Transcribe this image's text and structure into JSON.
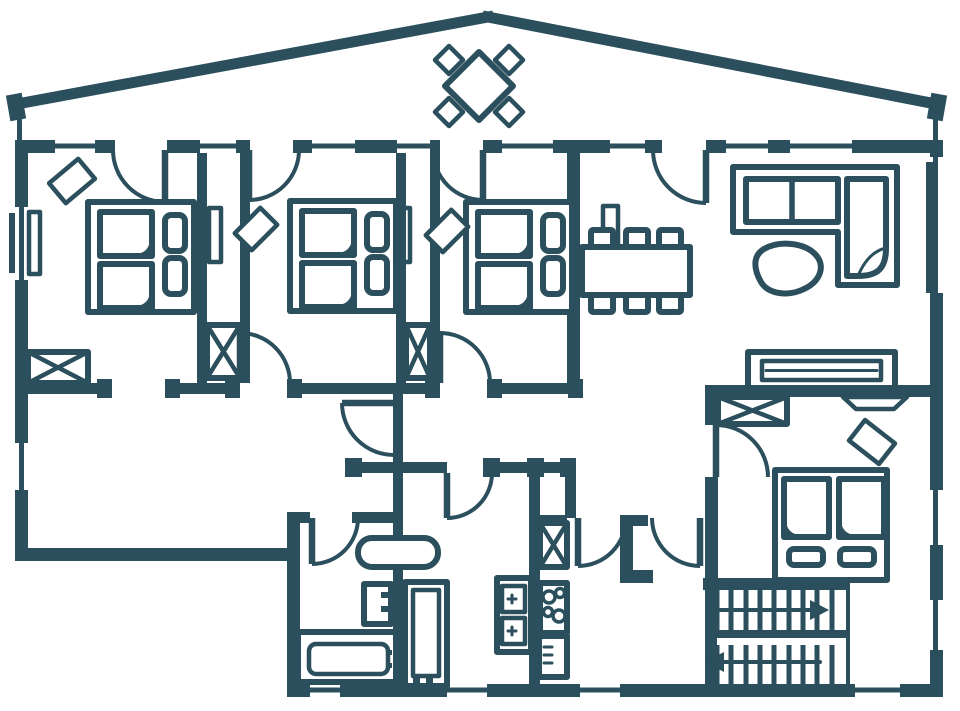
{
  "title": "apartment-floor-plan",
  "colors": {
    "wall": "#2b4f5c",
    "background": "#ffffff"
  },
  "floor_plan": {
    "type": "architectural-plan",
    "rooms": [
      {
        "name": "terrace",
        "furniture": [
          "diamond-table",
          "four-terrace-chairs"
        ]
      },
      {
        "name": "bedroom-1",
        "furniture": [
          "double-bed",
          "two-nightstands",
          "chair",
          "wardrobe-x",
          "window-seat"
        ]
      },
      {
        "name": "bedroom-2",
        "furniture": [
          "double-bed",
          "two-nightstands",
          "chair"
        ]
      },
      {
        "name": "bedroom-3",
        "furniture": [
          "double-bed",
          "two-nightstands",
          "chair"
        ]
      },
      {
        "name": "dining-room",
        "furniture": [
          "dining-table",
          "six-chairs"
        ]
      },
      {
        "name": "living-room",
        "furniture": [
          "corner-sofa",
          "organic-coffee-table",
          "sideboard"
        ]
      },
      {
        "name": "bedroom-4",
        "furniture": [
          "double-bed",
          "two-nightstands",
          "chair",
          "wardrobe-x",
          "wall-tv"
        ]
      },
      {
        "name": "bathroom-1",
        "furniture": [
          "bathtub",
          "toilet",
          "double-vanity"
        ]
      },
      {
        "name": "bathroom-2",
        "furniture": [
          "shower",
          "twin-sinks"
        ]
      },
      {
        "name": "kitchen-strip",
        "furniture": [
          "pantry-x",
          "cooktop-4-burners",
          "oven"
        ]
      },
      {
        "name": "stair-hall",
        "furniture": [
          "switchback-staircase",
          "up-arrow",
          "down-arrow"
        ]
      }
    ],
    "counts": {
      "double_beds": 4,
      "nightstands": 8,
      "x_symbol_closets": 5,
      "interior_door_arcs": 12,
      "dining_chairs": 6,
      "terrace_chairs": 4,
      "cooktop_burners": 4,
      "stair_flights": 2,
      "stair_direction_arrows": 2
    }
  }
}
